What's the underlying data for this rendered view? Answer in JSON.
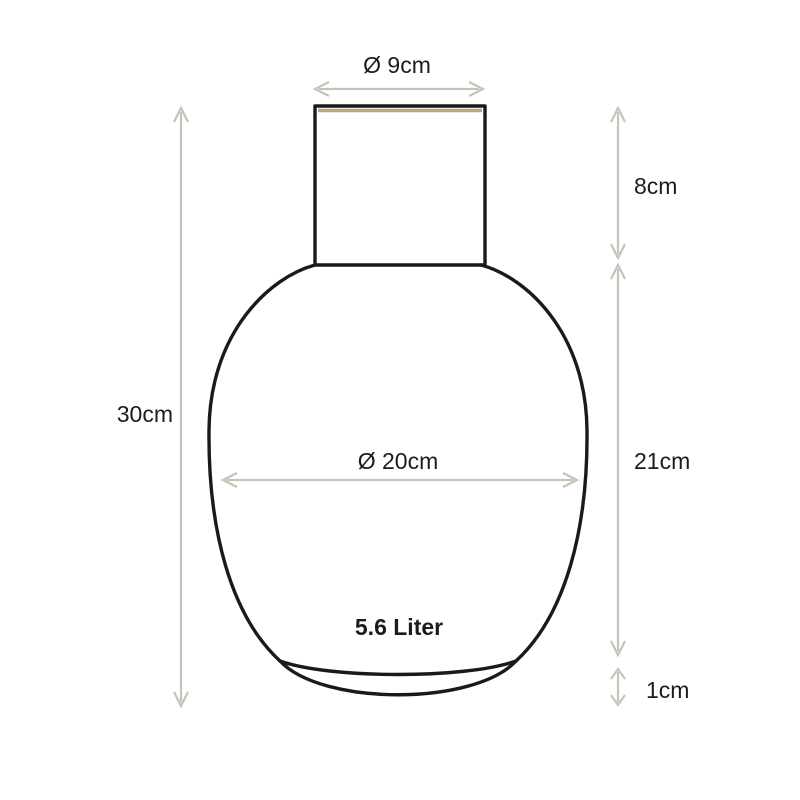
{
  "diagram": {
    "labels": {
      "top_diameter": "Ø 9cm",
      "neck_height": "8cm",
      "total_height": "30cm",
      "body_diameter": "Ø 20cm",
      "body_height": "21cm",
      "capacity": "5.6 Liter",
      "base_height": "1cm"
    },
    "colors": {
      "outline": "#1a1a1a",
      "arrow": "#c5c4ba",
      "rim_accent": "#bca87c",
      "text": "#1c1c1c",
      "background": "#ffffff"
    }
  }
}
